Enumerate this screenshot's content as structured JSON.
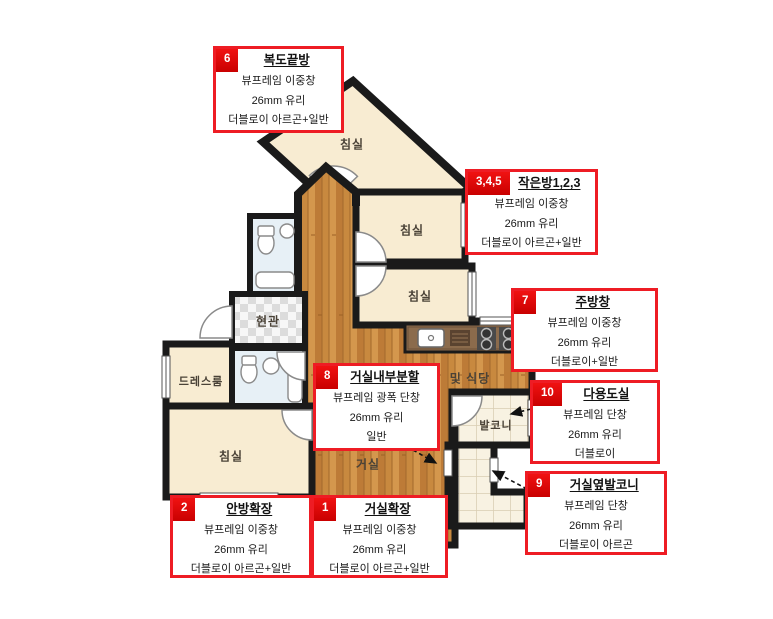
{
  "plan": {
    "room_labels": {
      "bedroom_top": "침실",
      "bedroom_mid": "침실",
      "bedroom_lower": "침실",
      "bedroom_master": "침실",
      "entrance": "현관",
      "dressroom": "드레스룸",
      "living": "거실",
      "dining": "및 식당",
      "balcony": "발코니"
    }
  },
  "callouts": [
    {
      "num": "6",
      "title": "복도끝방",
      "lines": [
        "뷰프레임 이중창",
        "26mm 유리",
        "더블로이 아르곤+일반"
      ]
    },
    {
      "num": "3,4,5",
      "title": "작은방1,2,3",
      "lines": [
        "뷰프레임 이중창",
        "26mm 유리",
        "더블로이 아르곤+일반"
      ]
    },
    {
      "num": "7",
      "title": "주방창",
      "lines": [
        "뷰프레임 이중창",
        "26mm 유리",
        "더블로이+일반"
      ]
    },
    {
      "num": "10",
      "title": "다용도실",
      "lines": [
        "뷰프레임 단창",
        "26mm 유리",
        "더블로이"
      ]
    },
    {
      "num": "9",
      "title": "거실옆발코니",
      "lines": [
        "뷰프레임 단창",
        "26mm 유리",
        "더블로이 아르곤"
      ]
    },
    {
      "num": "8",
      "title": "거실내부분할",
      "lines": [
        "뷰프레임 광폭 단창",
        "26mm 유리",
        "일반"
      ]
    },
    {
      "num": "2",
      "title": "안방확장",
      "lines": [
        "뷰프레임 이중창",
        "26mm 유리",
        "더블로이 아르곤+일반"
      ]
    },
    {
      "num": "1",
      "title": "거실확장",
      "lines": [
        "뷰프레임 이중창",
        "26mm 유리",
        "더블로이 아르곤+일반"
      ]
    }
  ],
  "colors": {
    "accent_red": "#ee1c24",
    "wall": "#1a1a1a",
    "room_cream": "#f8ecd2",
    "wood_floor": "#c8893f",
    "bathroom_blue": "#e7f0f6"
  }
}
